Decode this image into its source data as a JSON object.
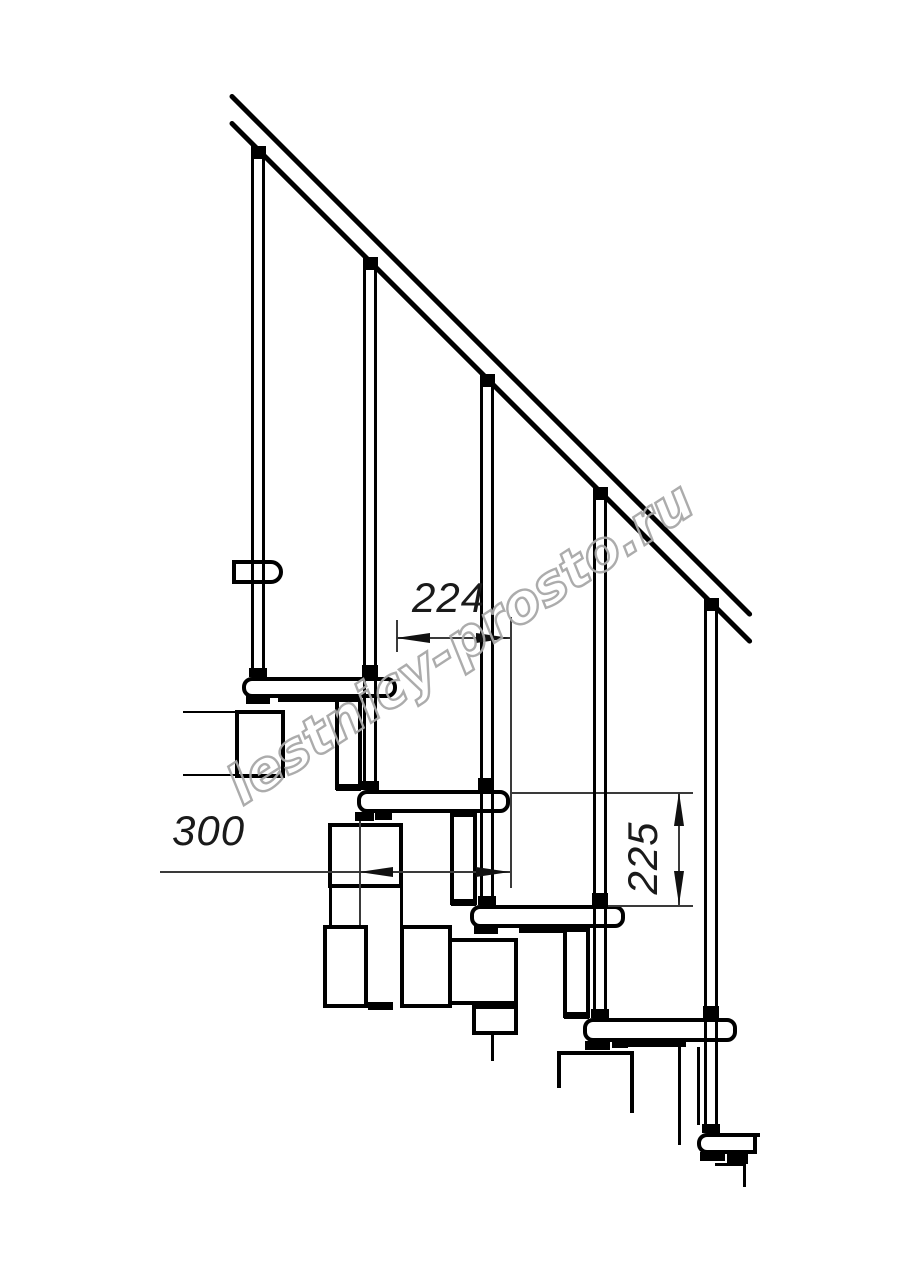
{
  "drawing": {
    "type": "technical line drawing",
    "subject": "modular staircase side elevation with handrail, balusters, treads and support modules",
    "dimensions": {
      "spacing": {
        "value": "224",
        "orientation": "horizontal"
      },
      "depth": {
        "value": "300",
        "orientation": "horizontal"
      },
      "rise": {
        "value": "225",
        "orientation": "vertical"
      }
    },
    "watermark": {
      "text": "lestnicy-prosto.ru",
      "color": "#b0b0b0"
    },
    "colors": {
      "line": "#000000",
      "dimension_line": "#3a3a3a",
      "background": "#ffffff"
    }
  }
}
